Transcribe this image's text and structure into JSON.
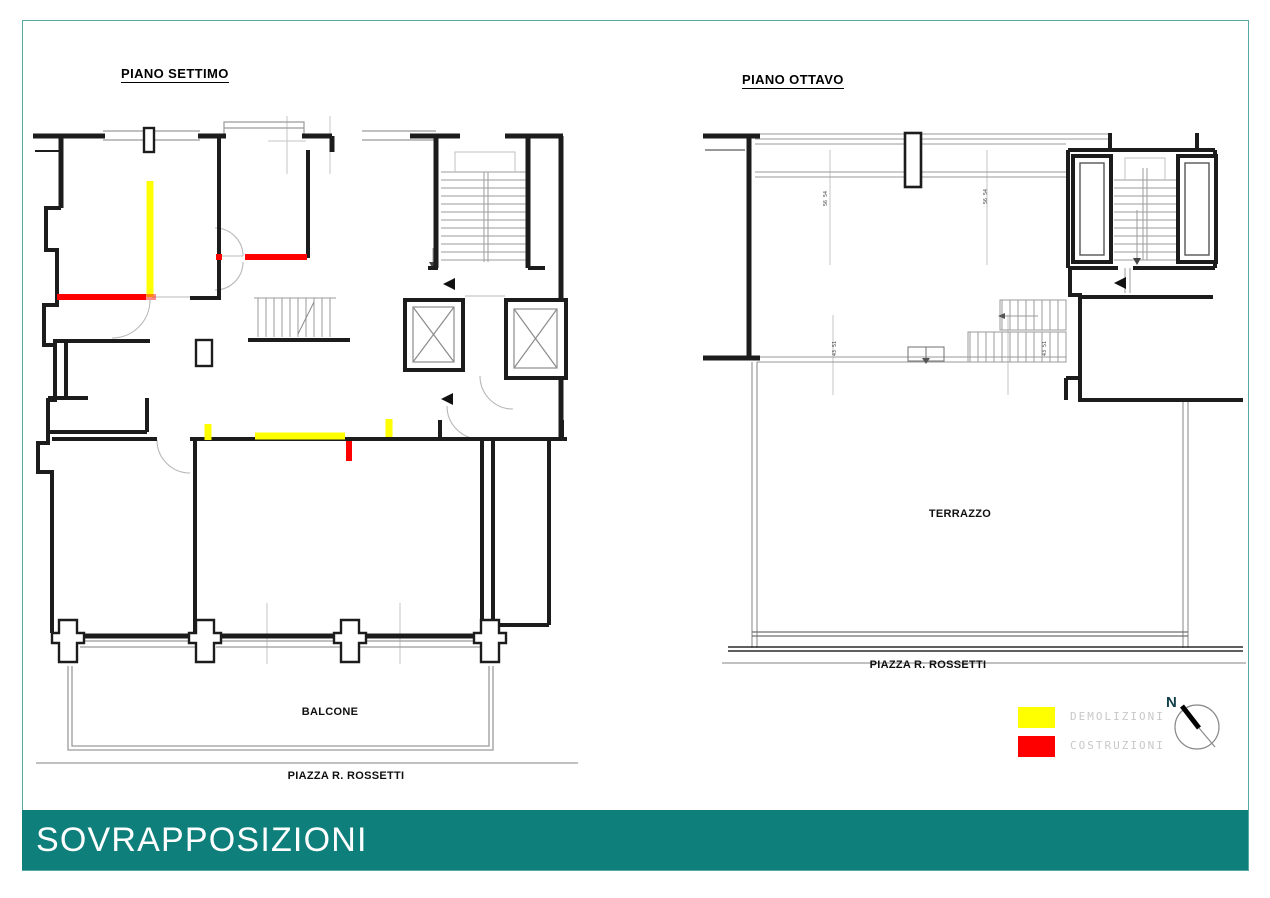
{
  "page": {
    "background": "#ffffff",
    "border_color": "#5aa8a4"
  },
  "plans": {
    "left": {
      "title": "PIANO SETTIMO",
      "balcony_label": "BALCONE",
      "street_label": "PIAZZA R. ROSSETTI"
    },
    "right": {
      "title": "PIANO OTTAVO",
      "terrace_label": "TERRAZZO",
      "street_label": "PIAZZA R. ROSSETTI"
    }
  },
  "legend": {
    "items": [
      {
        "label": "DEMOLIZIONI",
        "color": "#ffff00"
      },
      {
        "label": "COSTRUZIONI",
        "color": "#ff0000"
      }
    ]
  },
  "compass": {
    "north_label": "N"
  },
  "banner": {
    "title": "SOVRAPPOSIZIONI",
    "background": "#0e7f7a",
    "text_color": "#ffffff"
  },
  "annotations": {
    "dim_marks": [
      "56 54",
      "56 54",
      "43 51",
      "43 51"
    ]
  }
}
